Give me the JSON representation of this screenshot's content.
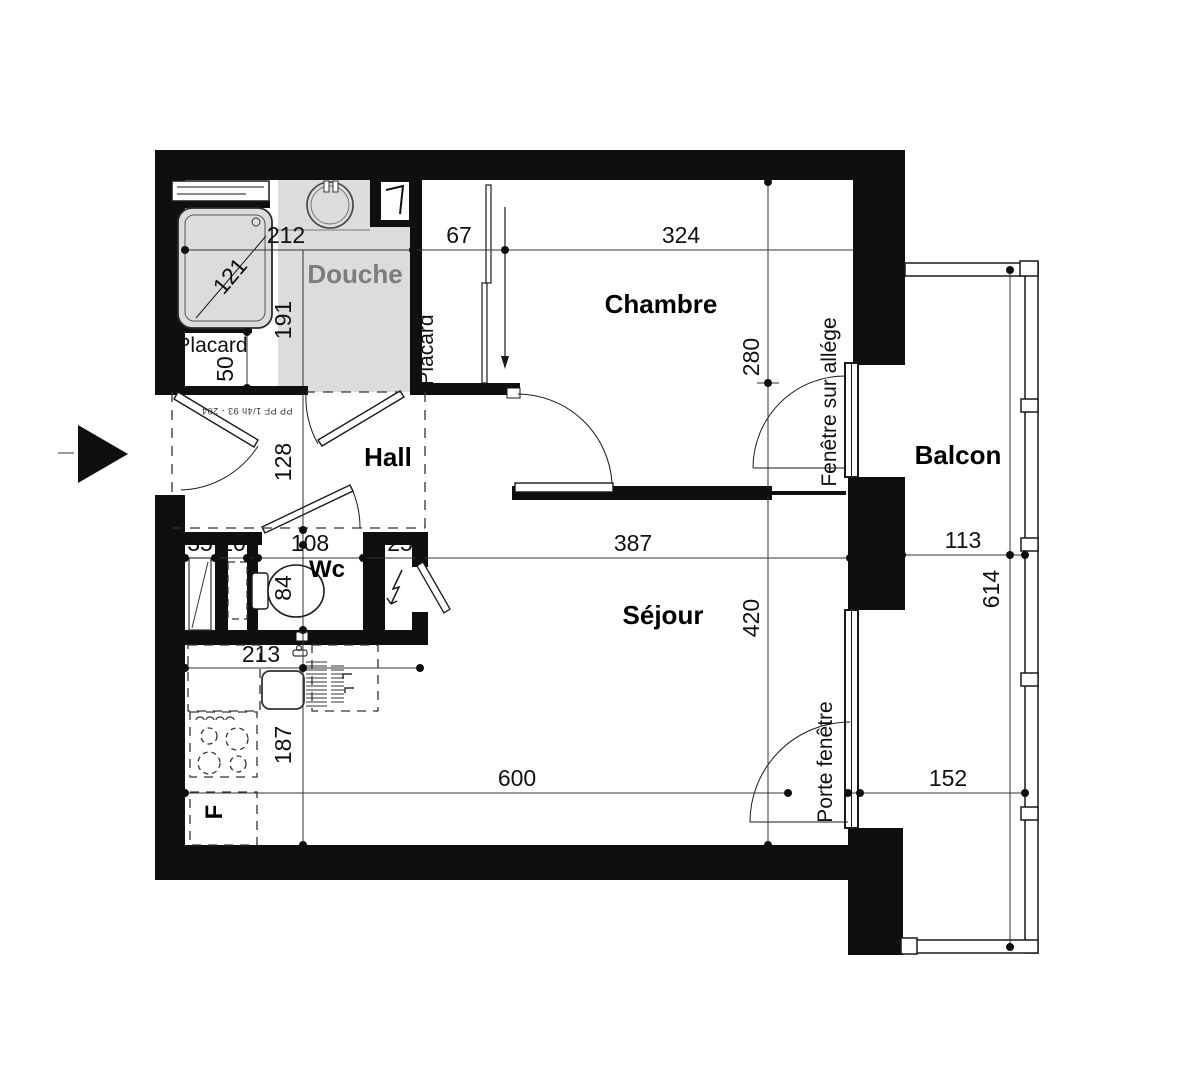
{
  "colors": {
    "wall": "#0f0f0f",
    "shower_floor": "#dcdcdc",
    "muted_label": "#7c7c7c",
    "line": "#1a1a1a"
  },
  "rooms": {
    "douche": "Douche",
    "chambre": "Chambre",
    "hall": "Hall",
    "wc": "Wc",
    "sejour": "Séjour",
    "balcon": "Balcon"
  },
  "closets": {
    "entry_placard": "Placard",
    "chambre_placard": "Placard"
  },
  "appliances": {
    "fridge": "F"
  },
  "openings": {
    "window_chambre": "Fenêtre sur allége",
    "window_sejour": "Porte fenêtre",
    "entry_door_spec": "PP PF 1/4h 93 - 204"
  },
  "dimensions": {
    "douche_width": "212",
    "douche_tray_diag": "121",
    "douche_depth": "191",
    "placard_chambre_width": "67",
    "chambre_width": "324",
    "chambre_window_offset": "280",
    "entry_placard_depth": "50",
    "hall_depth": "128",
    "duct_width": "35",
    "niche_width": "20",
    "wc_width": "108",
    "panel_width": "25",
    "wc_depth": "84",
    "sejour_width": "387",
    "balcon_width": "113",
    "sejour_depth": "420",
    "balcon_length": "614",
    "kitchen_counter": "213",
    "kitchen_depth": "187",
    "sejour_length": "600",
    "balcon_south": "152"
  }
}
